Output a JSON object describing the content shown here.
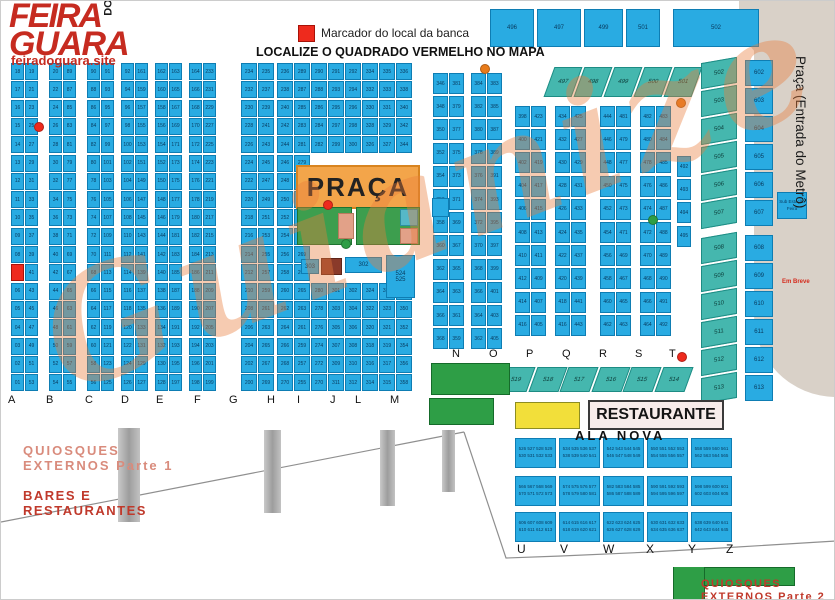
{
  "header": {
    "logo_line1": "FEIRA",
    "logo_do": "DO",
    "logo_line2": "GUARA",
    "site": "feiradoguara.site",
    "legend_label": "Marcador do local da banca",
    "title": "LOCALIZE O QUADRADO VERMELHO NO MAPA"
  },
  "watermark_text": "Guianize",
  "colors": {
    "stall_blue": "#29abe2",
    "marker_red": "#ee2a1d",
    "praca_orange": "#f3a54a",
    "green": "#3d9e4e",
    "teal": "#45b7ae",
    "brand_red": "#c62b20"
  },
  "praca": {
    "label": "PRAÇA"
  },
  "left_grid": {
    "letters": [
      "A",
      "B",
      "C",
      "D",
      "E",
      "F",
      "G",
      "H",
      "I",
      "J",
      "L",
      "M"
    ],
    "pairs": [
      {
        "letter": "A",
        "marker_row": 11,
        "left": [
          "18",
          "17",
          "16",
          "15",
          "14",
          "13",
          "12",
          "11",
          "10",
          "09",
          "08",
          "07",
          "06",
          "05",
          "04",
          "03",
          "02",
          "01"
        ],
        "right": [
          "19",
          "21",
          "23",
          "25",
          "27",
          "29",
          "31",
          "33",
          "35",
          "37",
          "39",
          "41",
          "43",
          "45",
          "47",
          "49",
          "51",
          "53"
        ]
      },
      {
        "letter": "B",
        "left": [
          "20",
          "22",
          "24",
          "26",
          "28",
          "30",
          "32",
          "34",
          "36",
          "38",
          "40",
          "42",
          "44",
          "46",
          "48",
          "50",
          "52",
          "54"
        ],
        "right": [
          "89",
          "87",
          "85",
          "83",
          "81",
          "79",
          "77",
          "75",
          "73",
          "71",
          "69",
          "67",
          "65",
          "63",
          "61",
          "59",
          "57",
          "55"
        ]
      },
      {
        "letter": "C",
        "left": [
          "90",
          "88",
          "86",
          "84",
          "82",
          "80",
          "78",
          "76",
          "74",
          "72",
          "70",
          "68",
          "66",
          "64",
          "62",
          "60",
          "58",
          "56"
        ],
        "right": [
          "91",
          "93",
          "95",
          "97",
          "99",
          "101",
          "103",
          "105",
          "107",
          "109",
          "111",
          "113",
          "115",
          "117",
          "119",
          "121",
          "123",
          "125"
        ]
      },
      {
        "letter": "D",
        "left": [
          "92",
          "94",
          "96",
          "98",
          "100",
          "102",
          "104",
          "106",
          "108",
          "110",
          "112",
          "114",
          "116",
          "118",
          "120",
          "122",
          "124",
          "126"
        ],
        "right": [
          "161",
          "159",
          "157",
          "155",
          "153",
          "151",
          "149",
          "147",
          "145",
          "143",
          "141",
          "139",
          "137",
          "135",
          "133",
          "131",
          "129",
          "127"
        ]
      },
      {
        "letter": "E",
        "left": [
          "162",
          "160",
          "158",
          "156",
          "154",
          "152",
          "150",
          "148",
          "146",
          "144",
          "142",
          "140",
          "138",
          "136",
          "134",
          "132",
          "130",
          "128"
        ],
        "right": [
          "163",
          "165",
          "167",
          "169",
          "171",
          "173",
          "175",
          "177",
          "179",
          "181",
          "183",
          "185",
          "187",
          "189",
          "191",
          "193",
          "195",
          "197"
        ]
      },
      {
        "letter": "F",
        "left": [
          "164",
          "166",
          "168",
          "170",
          "172",
          "174",
          "176",
          "178",
          "180",
          "182",
          "184",
          "186",
          "188",
          "190",
          "192",
          "194",
          "196",
          "198"
        ],
        "right": [
          "233",
          "231",
          "229",
          "227",
          "225",
          "223",
          "221",
          "219",
          "217",
          "215",
          "213",
          "211",
          "209",
          "207",
          "205",
          "203",
          "201",
          "199"
        ]
      },
      {
        "letter": "G",
        "left": [
          "234",
          "232",
          "230",
          "228",
          "226",
          "224",
          "222",
          "220",
          "218",
          "216",
          "214",
          "212",
          "210",
          "208",
          "206",
          "204",
          "202",
          "200"
        ],
        "right": [
          "235",
          "237",
          "239",
          "241",
          "243",
          "245",
          "247",
          "249",
          "251",
          "253",
          "255",
          "257",
          "259",
          "261",
          "263",
          "265",
          "267",
          "269"
        ]
      },
      {
        "letter": "H",
        "left": [
          "236",
          "238",
          "240",
          "242",
          "244",
          "246",
          "248",
          "250",
          "252",
          "254",
          "256",
          "258",
          "260",
          "262",
          "264",
          "266",
          "268",
          "270"
        ],
        "right": [
          "289",
          "287",
          "285",
          "283",
          "281",
          "279",
          "277",
          "275",
          "273",
          "271",
          "269",
          "267",
          "265",
          "263",
          "261",
          "259",
          "257",
          "255"
        ]
      },
      {
        "letter": "I",
        "left": [
          "290",
          "288",
          "286",
          "284",
          "282",
          "",
          "",
          "",
          "",
          "",
          "",
          "",
          "280",
          "278",
          "276",
          "274",
          "272",
          "270"
        ],
        "right": [
          "291",
          "293",
          "295",
          "297",
          "299",
          "",
          "",
          "",
          "",
          "",
          "",
          "",
          "301",
          "303",
          "305",
          "307",
          "309",
          "311"
        ]
      },
      {
        "letter": "J",
        "left": [
          "292",
          "294",
          "296",
          "298",
          "300",
          "",
          "",
          "",
          "",
          "",
          "",
          "",
          "302",
          "304",
          "306",
          "308",
          "310",
          "312"
        ],
        "right": [
          "334",
          "332",
          "330",
          "328",
          "326",
          "",
          "",
          "",
          "",
          "",
          "",
          "",
          "324",
          "322",
          "320",
          "318",
          "316",
          "314"
        ]
      },
      {
        "letter": "L",
        "left": [
          "335",
          "333",
          "331",
          "329",
          "327",
          "",
          "",
          "",
          "",
          "",
          "",
          "",
          "325",
          "323",
          "321",
          "319",
          "317",
          "315"
        ],
        "right": [
          "336",
          "338",
          "340",
          "342",
          "344",
          "",
          "",
          "",
          "",
          "",
          "",
          "",
          "348",
          "350",
          "352",
          "354",
          "356",
          "358"
        ]
      }
    ]
  },
  "right_grid": {
    "letters": [
      "N",
      "O",
      "P",
      "Q",
      "R",
      "S",
      "T"
    ],
    "pairs": [
      {
        "letter": "N",
        "left": [
          "346",
          "348",
          "350",
          "352",
          "354",
          "356",
          "358",
          "360",
          "362",
          "364",
          "366",
          "368"
        ],
        "right": [
          "381",
          "379",
          "377",
          "375",
          "373",
          "371",
          "369",
          "367",
          "365",
          "363",
          "361",
          "359"
        ]
      },
      {
        "letter": "O",
        "left": [
          "384",
          "382",
          "380",
          "378",
          "376",
          "374",
          "372",
          "370",
          "368",
          "366",
          "364",
          "362"
        ],
        "right": [
          "383",
          "385",
          "387",
          "389",
          "391",
          "393",
          "395",
          "397",
          "399",
          "401",
          "403",
          "405"
        ]
      },
      {
        "letter": "P",
        "left": [
          "398",
          "400",
          "402",
          "404",
          "406",
          "408",
          "410",
          "412",
          "414",
          "416"
        ],
        "right": [
          "423",
          "421",
          "419",
          "417",
          "415",
          "413",
          "411",
          "409",
          "407",
          "405"
        ]
      },
      {
        "letter": "Q",
        "left": [
          "434",
          "432",
          "430",
          "428",
          "426",
          "424",
          "422",
          "420",
          "418",
          "416"
        ],
        "right": [
          "425",
          "427",
          "429",
          "431",
          "433",
          "435",
          "437",
          "439",
          "441",
          "443"
        ]
      },
      {
        "letter": "R",
        "left": [
          "444",
          "446",
          "448",
          "450",
          "452",
          "454",
          "456",
          "458",
          "460",
          "462"
        ],
        "right": [
          "481",
          "479",
          "477",
          "475",
          "473",
          "471",
          "469",
          "467",
          "465",
          "463"
        ]
      },
      {
        "letter": "S",
        "left": [
          "482",
          "480",
          "478",
          "476",
          "474",
          "472",
          "470",
          "468",
          "466",
          "464"
        ],
        "right": [
          "483",
          "484",
          "485",
          "486",
          "487",
          "488",
          "489",
          "490",
          "491",
          "492"
        ]
      }
    ],
    "t_cells": [
      "492",
      "493",
      "494",
      "495"
    ]
  },
  "special_cells": [
    {
      "label": "303",
      "type": "blue"
    },
    {
      "label": "",
      "type": "dkred"
    },
    {
      "label": "302",
      "type": "blue"
    },
    {
      "label": "524",
      "label2": "525",
      "type": "blue"
    }
  ],
  "top_blocks": [
    "496",
    "497",
    "499",
    "501",
    "502"
  ],
  "tilted_top_row": [
    "497",
    "498",
    "499",
    "500",
    "501"
  ],
  "tilted_row_51x": [
    "519",
    "518",
    "517",
    "516",
    "515",
    "514"
  ],
  "far_right": {
    "tilted_cells": [
      "502",
      "503",
      "504",
      "505",
      "506",
      "507",
      "508",
      "509",
      "510",
      "511",
      "512",
      "513"
    ],
    "straight_cells": [
      "602",
      "603",
      "604",
      "605",
      "606",
      "607",
      "608",
      "609",
      "610",
      "611",
      "612",
      "613"
    ],
    "substation": "Sub Estação Feira",
    "em_breve": "Em Breve",
    "metro_label": "Praça (Entrada do Metrô)"
  },
  "ala_nova": {
    "title": "ALA NOVA",
    "restaurante": "RESTAURANTE",
    "letters": [
      "U",
      "V",
      "W",
      "X",
      "Y",
      "Z"
    ],
    "cells": [
      {
        "l1": "526 527 528 529",
        "l2": "530 531 532 533"
      },
      {
        "l1": "534 535 536 537",
        "l2": "538 539 540 541"
      },
      {
        "l1": "542 543 544 545",
        "l2": "546 547 548 549"
      },
      {
        "l1": "550 551 552 553",
        "l2": "554 555 556 557"
      },
      {
        "l1": "558 559 560 561",
        "l2": "562 563 564 565"
      },
      {
        "l1": "566 567 568 569",
        "l2": "570 571 572 573"
      },
      {
        "l1": "574 575 576 577",
        "l2": "578 579 580 581"
      },
      {
        "l1": "582 583 584 585",
        "l2": "586 587 588 589"
      },
      {
        "l1": "590 591 592 593",
        "l2": "594 595 596 597"
      },
      {
        "l1": "598 599 600 601",
        "l2": "602 603 604 605"
      },
      {
        "l1": "606 607 608 609",
        "l2": "610 611 612 613"
      },
      {
        "l1": "614 615 616 617",
        "l2": "618 619 620 621"
      },
      {
        "l1": "622 623 624 625",
        "l2": "626 627 628 629"
      },
      {
        "l1": "630 631 632 633",
        "l2": "634 635 636 637"
      },
      {
        "l1": "638 639 640 641",
        "l2": "642 643 644 645"
      }
    ]
  },
  "bottom": {
    "quiosques1_l1": "QUIOSQUES",
    "quiosques1_l2": "EXTERNOS Parte 1",
    "bares_l1": "BARES E",
    "bares_l2": "RESTAURANTES",
    "quiosques2_l1": "QUIOSQUES",
    "quiosques2_l2": "EXTERNOS Parte 2"
  }
}
